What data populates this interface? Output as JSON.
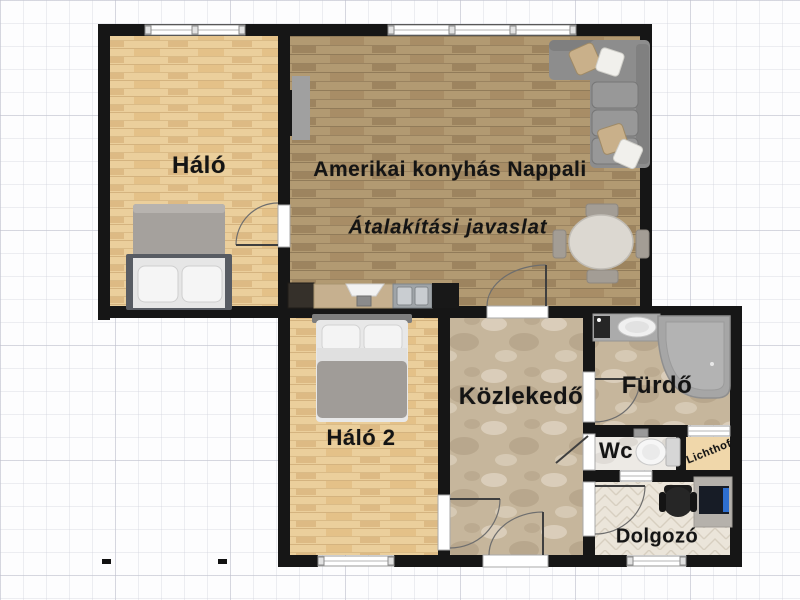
{
  "floorplan": {
    "note": "Átalakítási javaslat",
    "rooms": [
      {
        "id": "halo",
        "label": "Háló",
        "floor": "light-wood"
      },
      {
        "id": "nappali",
        "label": "Amerikai konyhás Nappali",
        "note": "Átalakítási javaslat",
        "floor": "oak-wood"
      },
      {
        "id": "halo2",
        "label": "Háló 2",
        "floor": "light-wood"
      },
      {
        "id": "kozlekedo",
        "label": "Közlekedő",
        "floor": "beige-marble"
      },
      {
        "id": "furdo",
        "label": "Fürdő",
        "floor": "beige-marble"
      },
      {
        "id": "wc",
        "label": "Wc",
        "floor": "white-marble"
      },
      {
        "id": "lichthof",
        "label": "Lichthof",
        "floor": "plaster-tan"
      },
      {
        "id": "dolgozo",
        "label": "Dolgozó",
        "floor": "herringbone-parquet"
      }
    ],
    "furniture": [
      "double-bed-halo",
      "double-bed-halo2",
      "corner-sofa-with-pillows",
      "oval-dining-table-4-chairs",
      "wall-tv",
      "kitchen-counter-with-sink",
      "bathroom-vanity-sink",
      "washing-machine",
      "corner-bathtub",
      "toilet",
      "desk-with-monitor",
      "office-chair"
    ],
    "palette": {
      "wall": "#161616",
      "light_wood": "#ebcf9c",
      "oak_wood": "#b29a72",
      "beige_marble": "#c9b9a0",
      "white_marble": "#edeae5",
      "lichthof_tan": "#f0d7aa",
      "herringbone": "#ebe5da",
      "sofa_gray": "#8d8d8d",
      "tub_gray": "#a6a6a6",
      "grid_line": "#dcdee8"
    }
  }
}
